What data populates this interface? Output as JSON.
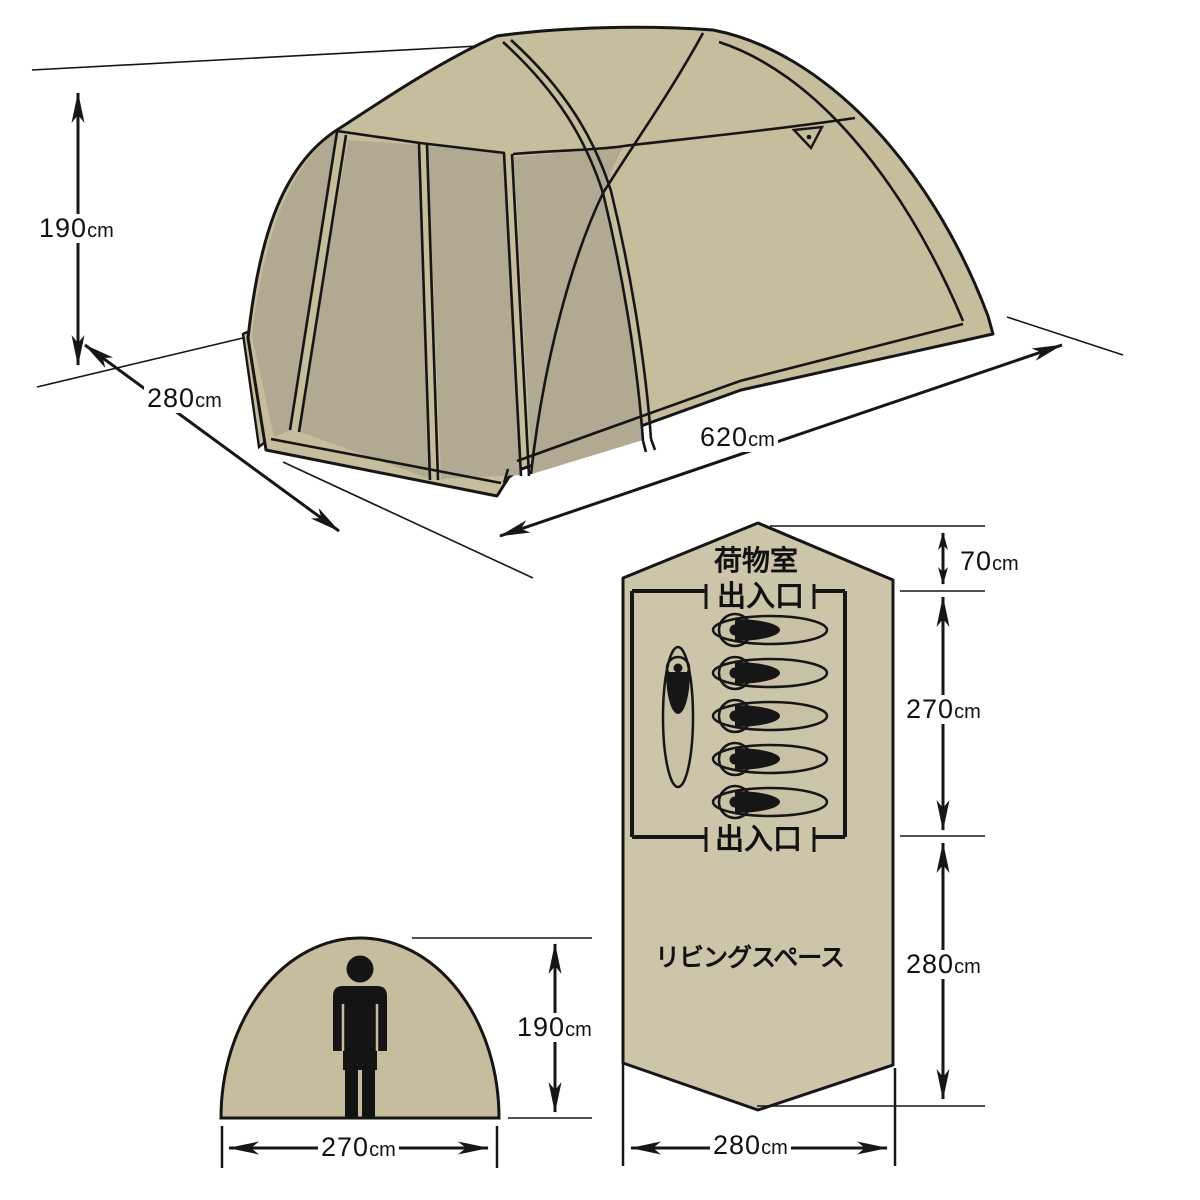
{
  "diagram_title": "tent-dimension-diagram",
  "perspective_view": {
    "height_value": "190",
    "height_unit": "cm",
    "width_value": "280",
    "width_unit": "cm",
    "length_value": "620",
    "length_unit": "cm"
  },
  "floor_plan": {
    "cargo_room": "荷物室",
    "entrance_top": "出入口",
    "entrance_bottom": "出入口",
    "living_space": "リビングスペース",
    "cargo_depth_value": "70",
    "cargo_depth_unit": "cm",
    "bedroom_depth_value": "270",
    "bedroom_depth_unit": "cm",
    "living_depth_value": "280",
    "living_depth_unit": "cm",
    "width_value": "280",
    "width_unit": "cm",
    "sleeping_bag_count_horizontal": 5,
    "sleeping_bag_count_vertical": 1
  },
  "front_view": {
    "height_value": "190",
    "height_unit": "cm",
    "width_value": "270",
    "width_unit": "cm"
  },
  "colors": {
    "fabric": "#c6bd9d",
    "mesh": "#b1a992",
    "floor": "#cdc5aa",
    "bag": "#c9c1a5",
    "outline": "#161616",
    "label": "#111111"
  }
}
